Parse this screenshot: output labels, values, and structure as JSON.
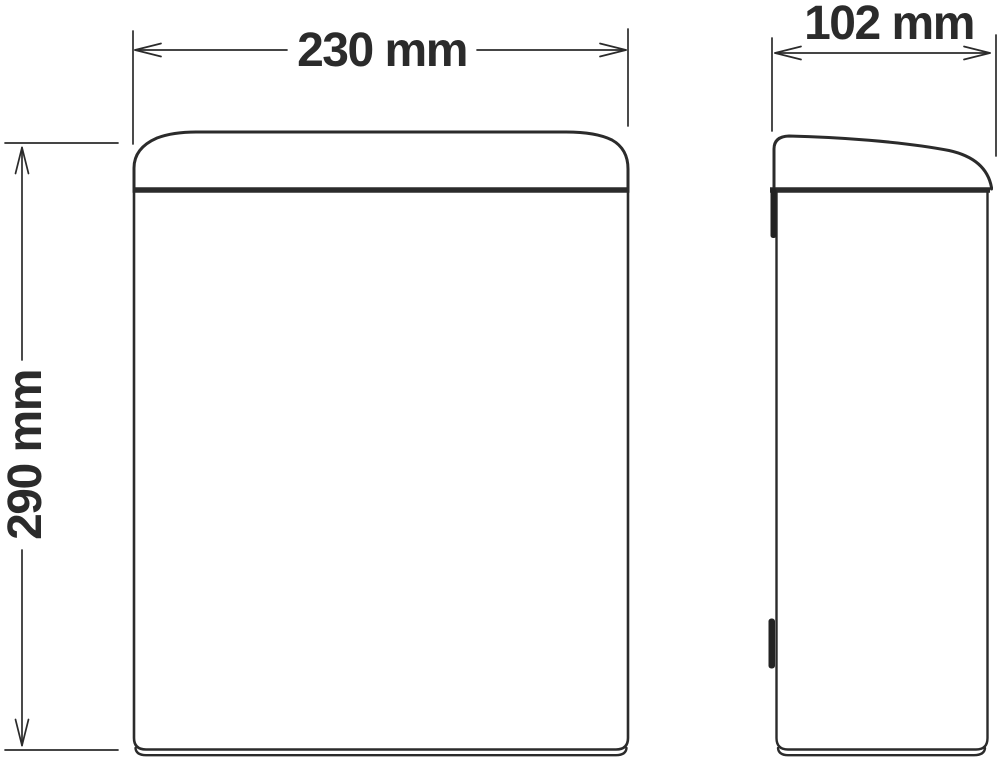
{
  "drawing": {
    "labels": {
      "width": "230 mm",
      "depth": "102 mm",
      "height": "290 mm"
    },
    "colors": {
      "line": "#2b2b2b",
      "accent_fill": "#232323",
      "background": "#ffffff"
    }
  }
}
